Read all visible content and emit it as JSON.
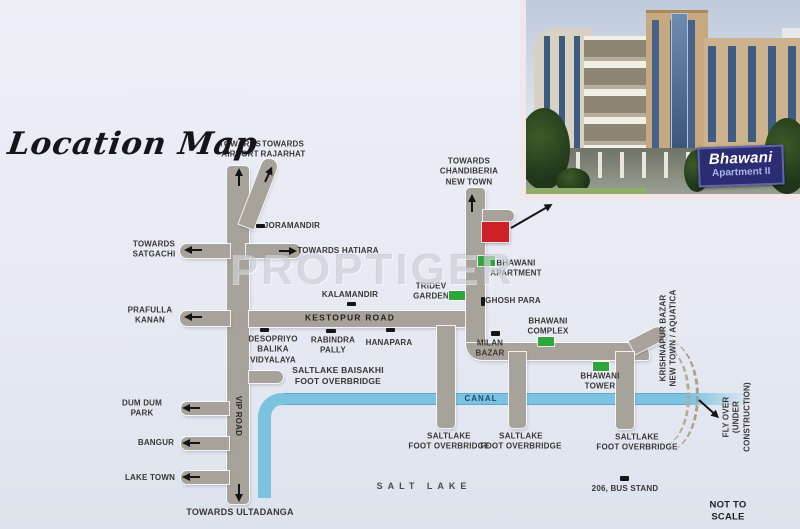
{
  "title": "Location Map",
  "watermark": "PROPTIGER",
  "colors": {
    "site_red": "#ce2027",
    "landmark_green": "#2fa63c",
    "road_gray": "#a8a39a",
    "canal_blue": "#7cc3e2",
    "sign_navy": "#2b2c71",
    "background": "#e7eaf3"
  },
  "photo": {
    "sign_line1": "Bhawani",
    "sign_line2": "Apartment II"
  },
  "map": {
    "labels": [
      {
        "id": "towards-airport",
        "text": "TOWARDS\nAIRPORT",
        "x": 240,
        "y": 150
      },
      {
        "id": "towards-rajarhat",
        "text": "TOWARDS\nRAJARHAT",
        "x": 283,
        "y": 150
      },
      {
        "id": "joramandir",
        "text": "JORAMANDIR",
        "x": 292,
        "y": 226
      },
      {
        "id": "towards-satgachi",
        "text": "TOWARDS\nSATGACHI",
        "x": 154,
        "y": 250
      },
      {
        "id": "towards-hatiara",
        "text": "TOWARDS HATIARA",
        "x": 338,
        "y": 251
      },
      {
        "id": "towards-chandiberia",
        "text": "TOWARDS\nCHANDIBERIA\nNEW TOWN",
        "x": 469,
        "y": 172
      },
      {
        "id": "prafulla-kanan",
        "text": "PRAFULLA\nKANAN",
        "x": 150,
        "y": 316
      },
      {
        "id": "kalamandir",
        "text": "KALAMANDIR",
        "x": 350,
        "y": 295
      },
      {
        "id": "kestopur-road",
        "text": "KESTOPUR ROAD",
        "x": 350,
        "y": 318,
        "size": 8.5,
        "spacing": 1.2,
        "color": "#24231f"
      },
      {
        "id": "desopriyo-balika-vidyalaya",
        "text": "DESOPRIYO\nBALIKA\nVIDYALAYA",
        "x": 273,
        "y": 350
      },
      {
        "id": "rabindra-pally",
        "text": "RABINDRA\nPALLY",
        "x": 333,
        "y": 346
      },
      {
        "id": "hanapara",
        "text": "HANAPARA",
        "x": 389,
        "y": 343
      },
      {
        "id": "saltlake-baisakhi",
        "text": "SALTLAKE BAISAKHI\nFOOT OVERBRIDGE",
        "x": 338,
        "y": 376,
        "size": 8.5
      },
      {
        "id": "tridev-garden",
        "text": "TRIDEV\nGARDEN",
        "x": 431,
        "y": 292
      },
      {
        "id": "bhawani-apartment",
        "text": "BHAWANI\nAPARTMENT",
        "x": 516,
        "y": 269
      },
      {
        "id": "ghosh-para",
        "text": "GHOSH PARA",
        "x": 513,
        "y": 301
      },
      {
        "id": "bhawani-complex",
        "text": "BHAWANI\nCOMPLEX",
        "x": 548,
        "y": 327
      },
      {
        "id": "milan-bazar",
        "text": "MILAN\nBAZAR",
        "x": 490,
        "y": 349
      },
      {
        "id": "bhawani-tower",
        "text": "BHAWANI\nTOWER",
        "x": 600,
        "y": 382
      },
      {
        "id": "dum-dum-park",
        "text": "DUM DUM\nPARK",
        "x": 142,
        "y": 409
      },
      {
        "id": "bangur",
        "text": "BANGUR",
        "x": 156,
        "y": 443
      },
      {
        "id": "lake-town",
        "text": "LAKE TOWN",
        "x": 150,
        "y": 478
      },
      {
        "id": "canal",
        "text": "CANAL",
        "x": 481,
        "y": 399,
        "spacing": 1,
        "color": "#1c4e6b"
      },
      {
        "id": "vip-road",
        "text": "VIP ROAD",
        "x": 238,
        "y": 416,
        "rot": 90,
        "color": "#2b2a26"
      },
      {
        "id": "saltlake-overbridge-1",
        "text": "SALTLAKE\nFOOT OVERBRIDGE",
        "x": 449,
        "y": 442
      },
      {
        "id": "saltlake-overbridge-2",
        "text": "SALTLAKE\nFOOT OVERBRIDGE",
        "x": 521,
        "y": 442
      },
      {
        "id": "saltlake-overbridge-3",
        "text": "SALTLAKE\nFOOT OVERBRIDGE",
        "x": 637,
        "y": 443
      },
      {
        "id": "salt-lake",
        "text": "SALT LAKE",
        "x": 424,
        "y": 487,
        "size": 9,
        "spacing": 5,
        "color": "#4a4a55"
      },
      {
        "id": "bus-stand",
        "text": "206, BUS STAND",
        "x": 625,
        "y": 489
      },
      {
        "id": "krishnapur-bazar",
        "text": "KRISHNAPUR BAZAR\nNEW TOWN / AQUATICA",
        "x": 669,
        "y": 338,
        "rot": -90
      },
      {
        "id": "fly-over",
        "text": "FLY OVER\n(UNDER CONSTRUCTION)",
        "x": 737,
        "y": 417,
        "rot": -90
      },
      {
        "id": "towards-ultadanga",
        "text": "TOWARDS ULTADANGA",
        "x": 240,
        "y": 513,
        "size": 9
      },
      {
        "id": "not-to-scale",
        "text": "NOT TO SCALE",
        "x": 728,
        "y": 512,
        "size": 9.5,
        "color": "#1e1e22"
      }
    ],
    "markers": [
      {
        "id": "joramandir",
        "x": 256,
        "y": 224,
        "w": 9,
        "h": 4
      },
      {
        "id": "kalamandir",
        "x": 347,
        "y": 302,
        "w": 9,
        "h": 4
      },
      {
        "id": "desopriyo",
        "x": 260,
        "y": 328,
        "w": 9,
        "h": 4
      },
      {
        "id": "rabindra",
        "x": 326,
        "y": 329,
        "w": 10,
        "h": 4
      },
      {
        "id": "hanapara",
        "x": 386,
        "y": 328,
        "w": 9,
        "h": 4
      },
      {
        "id": "ghosh-para",
        "x": 481,
        "y": 297,
        "w": 4,
        "h": 9
      },
      {
        "id": "milan-bazar",
        "x": 491,
        "y": 331,
        "w": 9,
        "h": 5
      },
      {
        "id": "bus-stand",
        "x": 620,
        "y": 476,
        "w": 9,
        "h": 5
      }
    ],
    "green_sites": [
      {
        "id": "tridev-garden",
        "x": 449,
        "y": 291,
        "w": 16,
        "h": 9
      },
      {
        "id": "bhawani-apartment",
        "x": 478,
        "y": 256,
        "w": 17,
        "h": 10
      },
      {
        "id": "bhawani-complex",
        "x": 538,
        "y": 337,
        "w": 16,
        "h": 9
      },
      {
        "id": "bhawani-tower",
        "x": 593,
        "y": 362,
        "w": 16,
        "h": 9
      }
    ],
    "arrows": [
      {
        "id": "airport-up",
        "x": 239,
        "y": 186,
        "rot": -90,
        "len": 18
      },
      {
        "id": "rajarhat-up",
        "x": 265,
        "y": 182,
        "rot": -65,
        "len": 17
      },
      {
        "id": "satgachi-left",
        "x": 202,
        "y": 250,
        "rot": 180,
        "len": 18
      },
      {
        "id": "hatiara-right",
        "x": 279,
        "y": 251,
        "rot": 0,
        "len": 18
      },
      {
        "id": "prafulla-left",
        "x": 202,
        "y": 317,
        "rot": 180,
        "len": 18
      },
      {
        "id": "chandiberia-up",
        "x": 472,
        "y": 212,
        "rot": -90,
        "len": 18
      },
      {
        "id": "dumdum-left",
        "x": 200,
        "y": 408,
        "rot": 180,
        "len": 18
      },
      {
        "id": "bangur-left",
        "x": 200,
        "y": 443,
        "rot": 180,
        "len": 18
      },
      {
        "id": "laketown-left",
        "x": 200,
        "y": 477,
        "rot": 180,
        "len": 18
      },
      {
        "id": "ultadanga-down",
        "x": 239,
        "y": 484,
        "rot": 90,
        "len": 18
      },
      {
        "id": "flyover-pointer",
        "x": 699,
        "y": 400,
        "rot": 42,
        "len": 27
      },
      {
        "id": "site-link",
        "x": 511,
        "y": 228,
        "rot": -30,
        "len": 48
      }
    ]
  }
}
